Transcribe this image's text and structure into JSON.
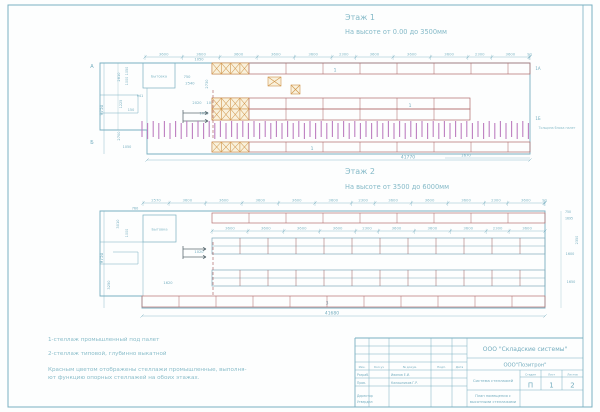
{
  "sheet": {
    "floor1": {
      "title": "Этаж 1",
      "subtitle": "На высоте от 0.00 до 3500мм",
      "room": "Бытовка",
      "top_dims": [
        "3600",
        "3600",
        "3600",
        "3600",
        "3600",
        "2300",
        "3600",
        "3600",
        "3600",
        "2300",
        "3600",
        "90"
      ],
      "bottom_dim": "41770",
      "overall_left": "9750",
      "left_dims": [
        "2810",
        "1050",
        "1000",
        "941",
        "1225",
        "150",
        "2700",
        "1050"
      ],
      "inner_dims": [
        "1050",
        "750",
        "2540",
        "2730",
        "2020",
        "1050",
        "1050"
      ],
      "right_dim": "1670",
      "right_note": "Толщина блока палет",
      "axes": [
        "А",
        "Б",
        "1А",
        "1Б"
      ],
      "rack_nums": [
        "1",
        "1",
        "1"
      ]
    },
    "floor2": {
      "title": "Этаж 2",
      "subtitle": "На высоте от 3500 до 6000мм",
      "room": "Бытовка",
      "top_dims": [
        "2570",
        "3600",
        "3600",
        "3600",
        "3600",
        "3600",
        "2300",
        "3600",
        "3600",
        "3600",
        "2300",
        "3600",
        "90"
      ],
      "mid_dims": [
        "3600",
        "3600",
        "3600",
        "3600",
        "2300",
        "3600",
        "3600",
        "3600",
        "2300",
        "3600"
      ],
      "bottom_dim": "41680",
      "overall_left": "9750",
      "left_dims": [
        "760",
        "3010",
        "1000",
        "1020",
        "1620",
        "3250"
      ],
      "right_dims": [
        "750",
        "1695",
        "2350",
        "1600",
        "1650"
      ],
      "rack_num": "3"
    },
    "notes": [
      "1-стеллаж промышленный под палет",
      "2-стеллаж типовой, глубинно выкатной",
      "Красным цветом отображены стеллажи промышленные, выполня-",
      "ют функцию опорных стеллажей на обоих этажах."
    ],
    "titleblock": {
      "org1": "ООО \"Складские системы\"",
      "org2": "ООО\"Позитрон\"",
      "col_izm": "Изм.",
      "col_koluch": "Кол.уч",
      "col_dokum": "№ докум.",
      "col_podp": "Подп.",
      "col_data": "Дата",
      "row1_role": "Разраб.",
      "row1_name": "Иванов Е.И.",
      "row2_role": "Пров.",
      "row2_name": "Калашников Г.Р.",
      "approve1": "Директор",
      "approve2": "Утвердил",
      "project": "Система стеллажей",
      "doc1": "План помещения с",
      "doc2": "высотными стеллажами",
      "stage_label": "Стадия",
      "sheet_label": "Лист",
      "sheets_label": "Листов",
      "stage": "П",
      "sheet_num": "1",
      "sheets_total": "2"
    }
  },
  "colors": {
    "frame": "#79b0c1",
    "dim_text": "#74adbf",
    "rack_red": "#b06a6a",
    "rack_pink": "#b47070",
    "hatch_orange": "#cf9348",
    "ticks_purple": "#bd7ec0"
  }
}
